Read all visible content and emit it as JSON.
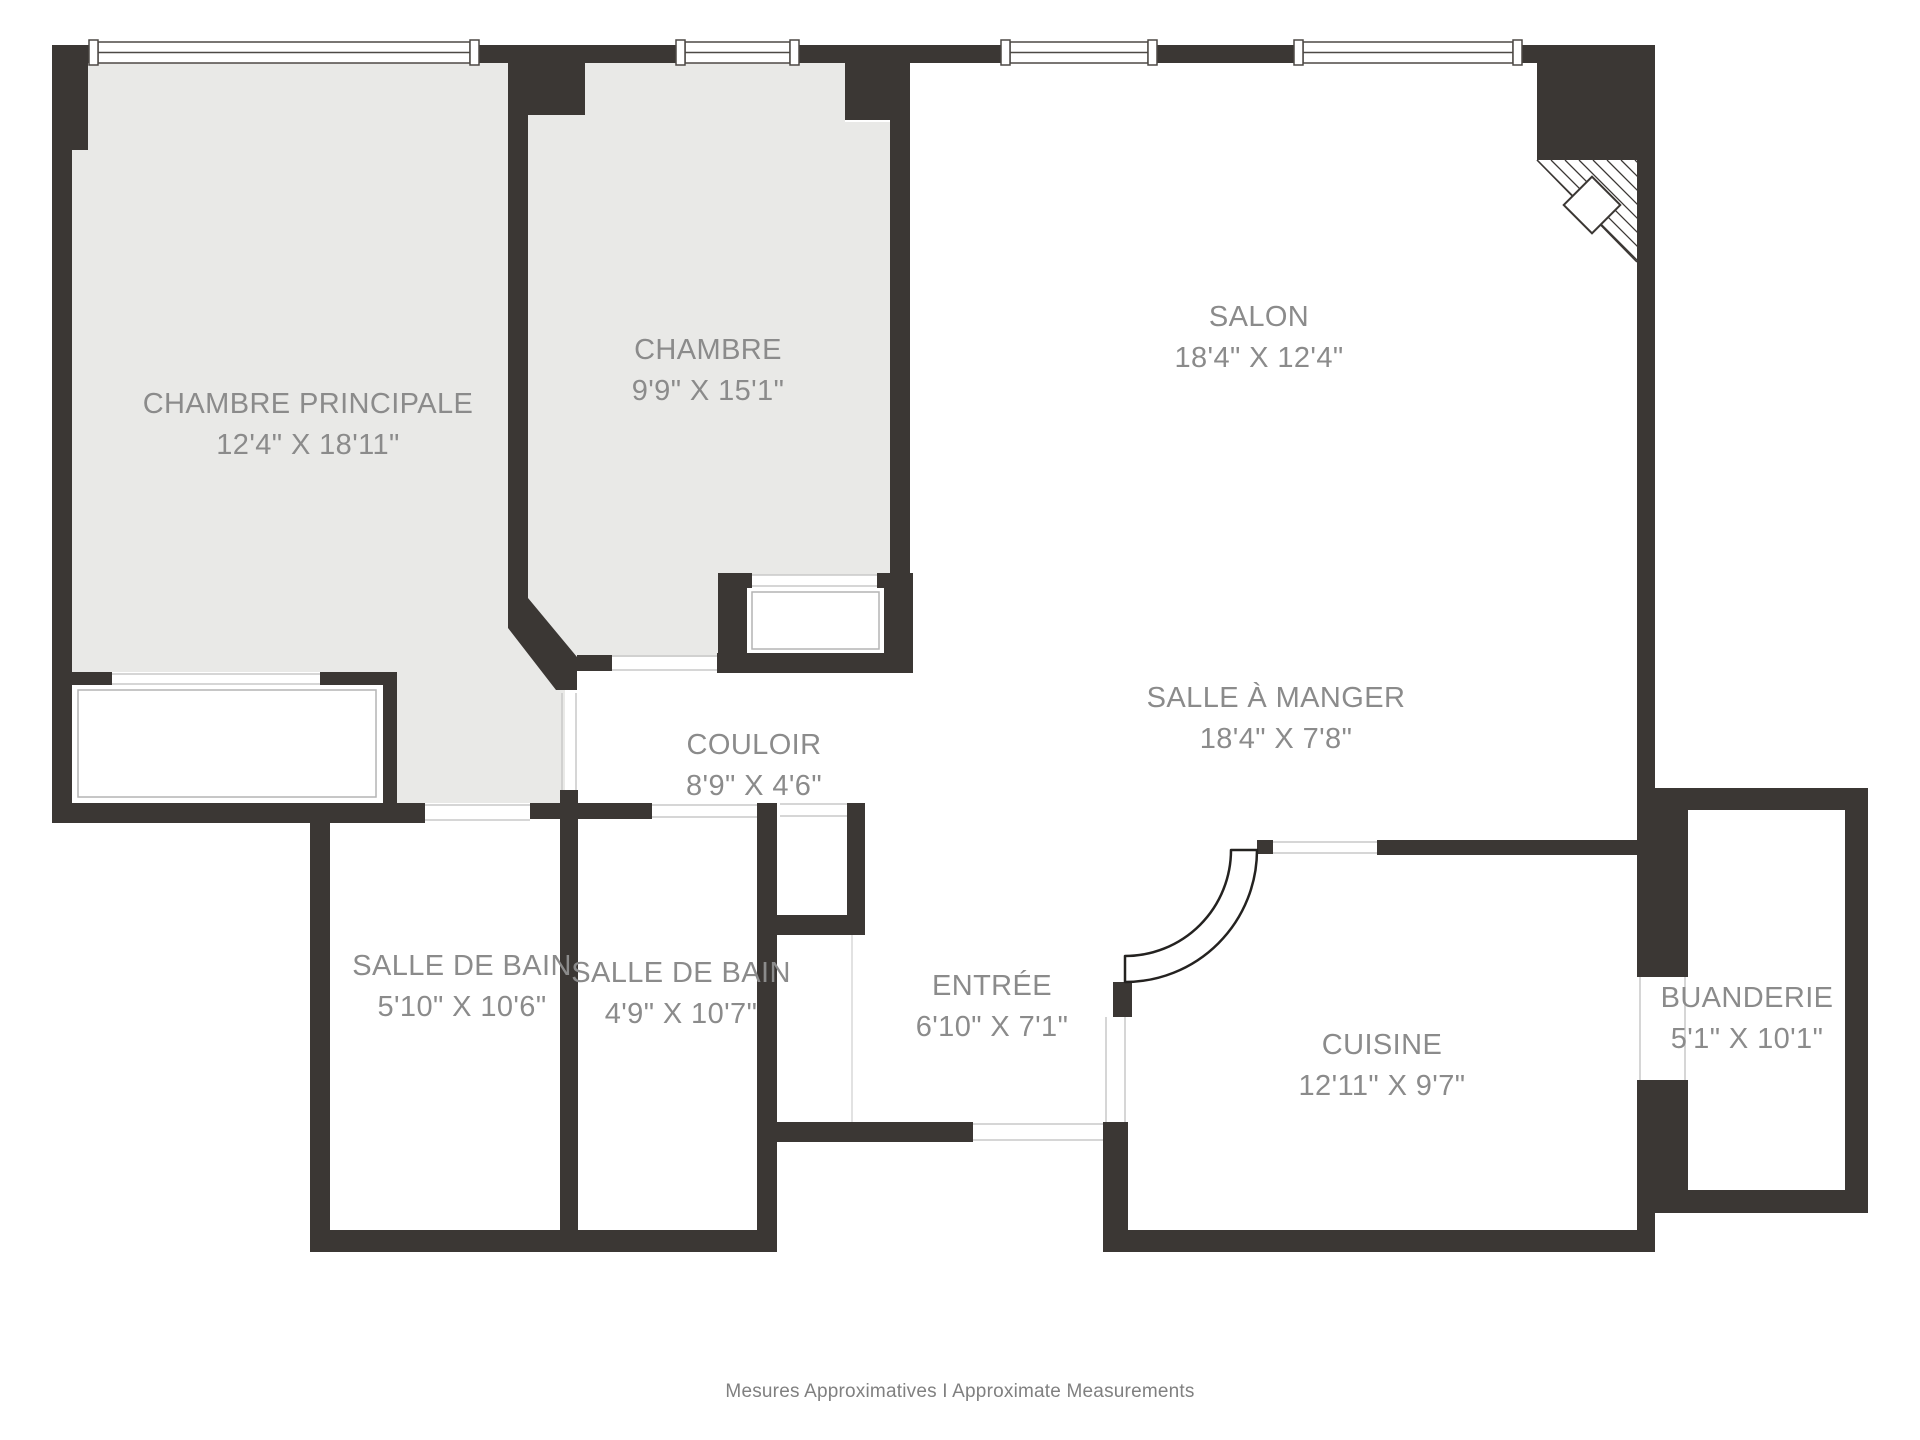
{
  "plan": {
    "rooms": [
      {
        "name": "CHAMBRE PRINCIPALE",
        "dims": "12'4\" X 18'11\""
      },
      {
        "name": "CHAMBRE",
        "dims": "9'9\" X 15'1\""
      },
      {
        "name": "SALON",
        "dims": "18'4\" X 12'4\""
      },
      {
        "name": "SALLE À MANGER",
        "dims": "18'4\" X 7'8\""
      },
      {
        "name": "COULOIR",
        "dims": "8'9\" X 4'6\""
      },
      {
        "name": "SALLE DE BAIN",
        "dims": "5'10\" X 10'6\""
      },
      {
        "name": "SALLE DE BAIN",
        "dims": "4'9\" X 10'7\""
      },
      {
        "name": "ENTRÉE",
        "dims": "6'10\" X 7'1\""
      },
      {
        "name": "CUISINE",
        "dims": "12'11\" X 9'7\""
      },
      {
        "name": "BUANDERIE",
        "dims": "5'1\" X 10'1\""
      }
    ],
    "footer": "Mesures Approximatives I Approximate Measurements",
    "colors": {
      "wall": "#3B3734",
      "bedroom_fill": "#E9E9E7",
      "label_text": "#8B8B8B",
      "footer_text": "#808080",
      "thin_line": "#C9C9C9",
      "window_frame": "#4D4945"
    }
  }
}
